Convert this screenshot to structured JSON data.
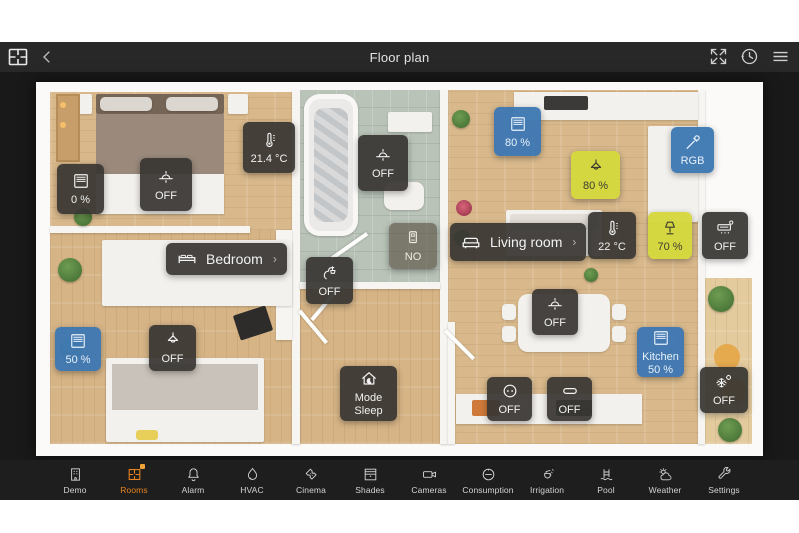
{
  "header": {
    "title": "Floor plan",
    "logo_icon": "floorplan-logo-icon",
    "back_icon": "back-chevron-icon",
    "expand_icon": "expand-icon",
    "history_icon": "history-clock-icon",
    "menu_icon": "hamburger-menu-icon"
  },
  "colors": {
    "accent_orange": "#E8851F",
    "tile_dark": "#383633",
    "tile_blue": "#3D78B2",
    "tile_yellow": "#D5D83E",
    "topbar_bg": "#282828",
    "content_bg": "#191919",
    "navbar_bg": "#1E1E1E"
  },
  "widgets": [
    {
      "id": "bedroom-blinds",
      "icon": "blinds-icon",
      "value": "0 %",
      "style": "blue-dark"
    },
    {
      "id": "bedroom-ceiling-light",
      "icon": "ceiling-light-icon",
      "value": "OFF"
    },
    {
      "id": "bedroom-temperature",
      "icon": "thermometer-icon",
      "value": "21.4 °C"
    },
    {
      "id": "bathroom-ceiling-light",
      "icon": "ceiling-light-icon",
      "value": "OFF"
    },
    {
      "id": "livingroom-blinds-top",
      "icon": "blinds-icon",
      "value": "80 %"
    },
    {
      "id": "kitchen-pendant-light",
      "icon": "pendant-light-icon",
      "value": "80 %"
    },
    {
      "id": "livingroom-rgb-light",
      "icon": "pipette-icon",
      "value": "RGB"
    },
    {
      "id": "hall-door-sensor",
      "icon": "door-sensor-icon",
      "value": "NO"
    },
    {
      "id": "livingroom-temperature",
      "icon": "thermometer-icon",
      "value": "22 °C"
    },
    {
      "id": "livingroom-table-lamp",
      "icon": "table-lamp-icon",
      "value": "70 %"
    },
    {
      "id": "livingroom-ac",
      "icon": "ac-unit-icon",
      "value": "OFF"
    },
    {
      "id": "hall-water-valve",
      "icon": "faucet-icon",
      "value": "OFF"
    },
    {
      "id": "office-blinds",
      "icon": "blinds-icon",
      "value": "50 %"
    },
    {
      "id": "office-pendant-light",
      "icon": "pendant-light-icon",
      "value": "OFF"
    },
    {
      "id": "dining-ceiling-light",
      "icon": "ceiling-light-icon",
      "value": "OFF"
    },
    {
      "id": "kitchen-blinds",
      "icon": "blinds-icon",
      "line1": "Kitchen",
      "line2": "50 %"
    },
    {
      "id": "house-mode",
      "icon": "house-moon-icon",
      "line1": "Mode",
      "line2": "Sleep"
    },
    {
      "id": "kitchen-socket",
      "icon": "socket-icon",
      "value": "OFF"
    },
    {
      "id": "kitchen-switch",
      "icon": "switch-icon",
      "value": "OFF"
    },
    {
      "id": "terrace-cooling",
      "icon": "snowflake-gear-icon",
      "value": "OFF"
    }
  ],
  "room_labels": [
    {
      "id": "bedroom",
      "icon": "bed-icon",
      "text": "Bedroom",
      "chevron": "›"
    },
    {
      "id": "living-room",
      "icon": "sofa-icon",
      "text": "Living room",
      "chevron": "›"
    }
  ],
  "nav": {
    "items": [
      {
        "id": "demo",
        "icon": "building-icon",
        "label": "Demo",
        "active": false
      },
      {
        "id": "rooms",
        "icon": "rooms-grid-icon",
        "label": "Rooms",
        "active": true
      },
      {
        "id": "alarm",
        "icon": "bell-icon",
        "label": "Alarm",
        "active": false
      },
      {
        "id": "hvac",
        "icon": "flame-icon",
        "label": "HVAC",
        "active": false
      },
      {
        "id": "cinema",
        "icon": "ticket-icon",
        "label": "Cinema",
        "active": false
      },
      {
        "id": "shades",
        "icon": "shades-icon",
        "label": "Shades",
        "active": false
      },
      {
        "id": "cameras",
        "icon": "camera-icon",
        "label": "Cameras",
        "active": false
      },
      {
        "id": "consumption",
        "icon": "meter-icon",
        "label": "Consumption",
        "active": false
      },
      {
        "id": "irrigation",
        "icon": "sprinkler-icon",
        "label": "Irrigation",
        "active": false
      },
      {
        "id": "pool",
        "icon": "pool-ladder-icon",
        "label": "Pool",
        "active": false
      },
      {
        "id": "weather",
        "icon": "sun-cloud-icon",
        "label": "Weather",
        "active": false
      },
      {
        "id": "settings",
        "icon": "wrench-icon",
        "label": "Settings",
        "active": false
      }
    ]
  }
}
